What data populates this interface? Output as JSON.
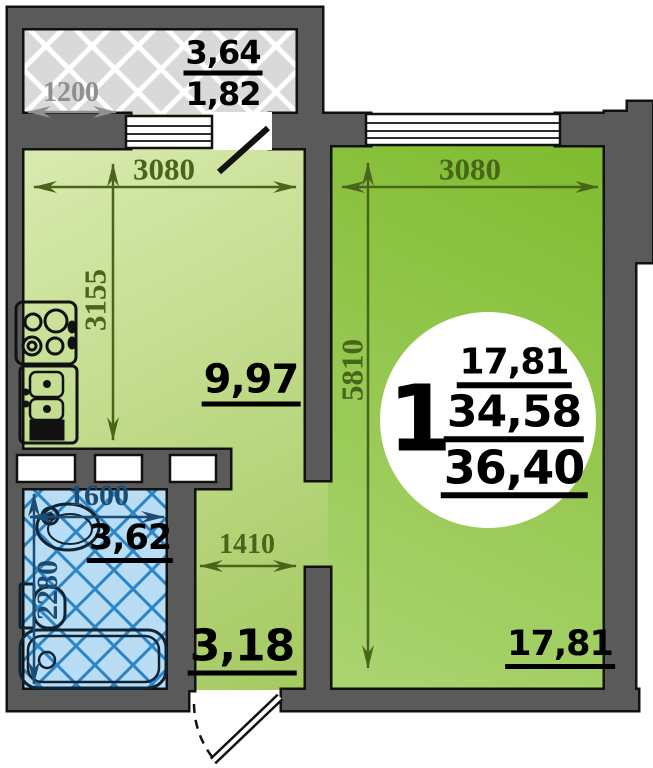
{
  "badge": {
    "unit_number": "1",
    "rooms_area": "17,81",
    "living_area": "34,58",
    "total_area": "36,40"
  },
  "rooms": {
    "balcony": {
      "area_m2": "3,64",
      "area_reduced_m2": "1,82",
      "dim_width": "1200"
    },
    "kitchen": {
      "area_m2": "9,97",
      "dim_width": "3080",
      "dim_depth": "3155"
    },
    "living": {
      "area_m2": "17,81",
      "dim_width": "3080",
      "dim_depth": "5810"
    },
    "bathroom": {
      "area_m2": "3,62",
      "dim_width": "1600",
      "dim_depth": "2280"
    },
    "hallway": {
      "area_m2": "3,18",
      "dim_width": "1410"
    }
  },
  "colors": {
    "wall": "#5a5a5a",
    "kitchen_green_light": "#dcecb4",
    "kitchen_green": "#a3c95f",
    "living_green_dark": "#7fbc2f",
    "living_green_light": "#abd471",
    "balcony_gray": "#d9d9d9",
    "bathroom_blue": "#b9ddf4",
    "bathroom_line": "#2c85c6",
    "dim_olive": "#48651a",
    "dim_gray": "#8f8f8f",
    "dim_blue": "#1c4b74",
    "badge_bg": "#ffffff"
  }
}
